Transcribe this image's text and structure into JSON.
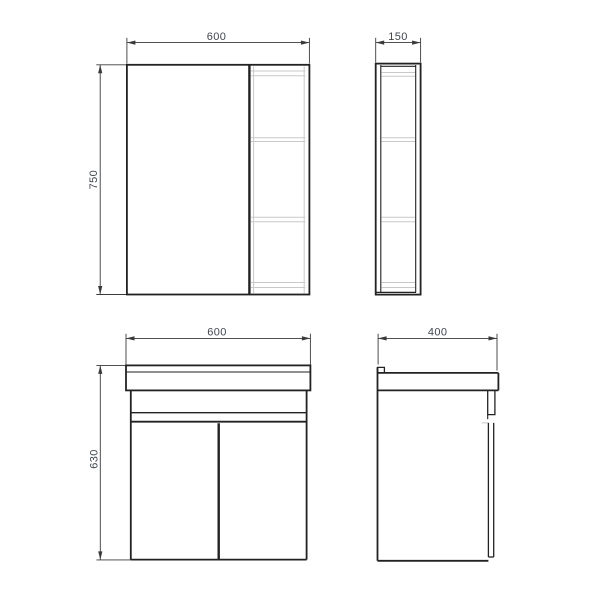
{
  "drawing": {
    "mirror_front": {
      "width_label": "600",
      "height_label": "750"
    },
    "mirror_side": {
      "depth_label": "150"
    },
    "vanity_front": {
      "width_label": "600",
      "height_label": "630"
    },
    "vanity_side": {
      "depth_label": "400"
    }
  },
  "colors": {
    "background": "#ffffff",
    "line_dark": "#222222",
    "line_dim": "#3a3a3a",
    "line_light": "#c9c9c9",
    "text_dim": "#40464f"
  }
}
